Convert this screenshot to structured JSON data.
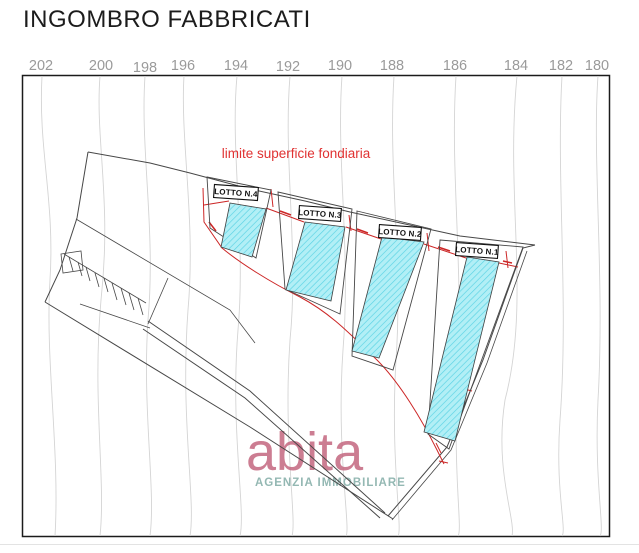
{
  "page": {
    "title": "INGOMBRO FABBRICATI"
  },
  "elevations": [
    "202",
    "200",
    "198",
    "196",
    "194",
    "192",
    "190",
    "188",
    "186",
    "184",
    "182",
    "180"
  ],
  "plan": {
    "red_boundary_label": "limite superficie fondiaria",
    "lots": [
      {
        "label": "LOTTO N.4"
      },
      {
        "label": "LOTTO N.3"
      },
      {
        "label": "LOTTO N.2"
      },
      {
        "label": "LOTTO N.1"
      }
    ],
    "colors": {
      "label_red": "#e03232",
      "dimension_red": "#cc2626",
      "lot_fill": "#b2eff6",
      "lot_hatch": "#59d2e4",
      "contour_gray": "#d4d4d4",
      "line_dark": "#474747",
      "elevation_gray": "#9a9a9a"
    }
  },
  "watermark": {
    "brand": "abita",
    "subtitle": "AGENZIA IMMOBILIARE",
    "brand_color": "#c4677f",
    "subtitle_color": "#94b8b3"
  }
}
